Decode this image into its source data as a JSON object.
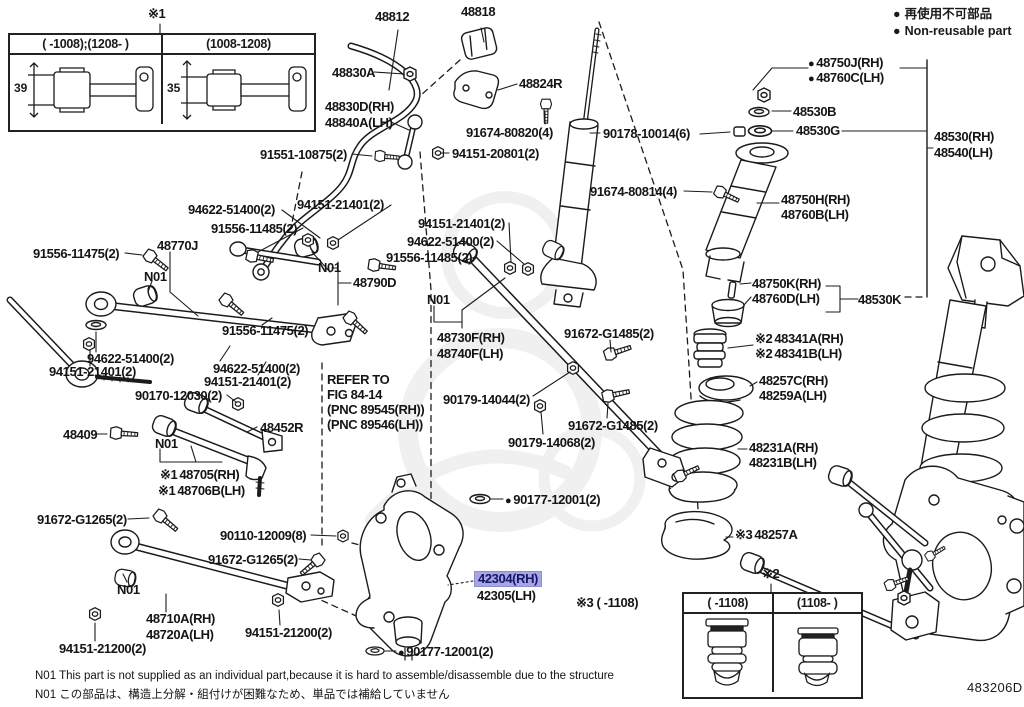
{
  "legend": {
    "bullet": "●",
    "jp": "再使用不可部品",
    "en": "Non-reusable part"
  },
  "markers": {
    "m1": "※1",
    "m2": "※2",
    "m3": "※3"
  },
  "table1": {
    "col1": "(      -1008);(1208-      )",
    "col2": "(1008-1208)",
    "dim1": "39",
    "dim2": "35"
  },
  "table2": {
    "col1": "(      -1108)",
    "col2": "(1108-      )"
  },
  "x3_note": "※3 (        -1108)",
  "notes": {
    "en": "N01   This part is not supplied as an individual part,because it is hard to assemble/disassemble due to the structure",
    "jp": "N01 この部品は、構造上分解・組付けが困難なため、単品では補給していません"
  },
  "doc_code": "483206D",
  "colors": {
    "highlight_bg": "#a7a5e2",
    "highlight_text": "#15156b",
    "line": "#1a1a1a"
  },
  "parts": {
    "p48812": "48812",
    "p48818": "48818",
    "p48830A": "48830A",
    "p48824R": "48824R",
    "p48830D": "48830D(RH)",
    "p48840A": "48840A(LH)",
    "p91674_80820": "91674-80820(4)",
    "p91551_10875": "91551-10875(2)",
    "p94151_20801": "94151-20801(2)",
    "p90178_10014": "90178-10014(6)",
    "p91674_80814": "91674-80814(4)",
    "p48750J": "48750J(RH)",
    "p48760C": "48760C(LH)",
    "p48530B": "48530B",
    "p48530G": "48530G",
    "p48530": "48530(RH)",
    "p48540": "48540(LH)",
    "p48750H": "48750H(RH)",
    "p48760B": "48760B(LH)",
    "p48750K": "48750K(RH)",
    "p48760D": "48760D(LH)",
    "p48530K": "48530K",
    "p48341A": "48341A(RH)",
    "p48341B": "48341B(LH)",
    "p48257C": "48257C(RH)",
    "p48259A": "48259A(LH)",
    "p48231A": "48231A(RH)",
    "p48231B": "48231B(LH)",
    "p48257A": "48257A",
    "p94622_51400": "94622-51400(2)",
    "p91556_11485": "91556-11485(2)",
    "p94151_21401": "94151-21401(2)",
    "p91556_11475": "91556-11475(2)",
    "p48770J": "48770J",
    "p48790D": "48790D",
    "p48730F": "48730F(RH)",
    "p48740F": "48740F(LH)",
    "p91672_G1485": "91672-G1485(2)",
    "p90179_14044": "90179-14044(2)",
    "p90179_14068": "90179-14068(2)",
    "p90170_12030": "90170-12030(2)",
    "p48409": "48409",
    "p48452R": "48452R",
    "p48705": "48705(RH)",
    "p48706B": "48706B(LH)",
    "p91672_G1265": "91672-G1265(2)",
    "p90110_12009": "90110-12009(8)",
    "p48710A": "48710A(RH)",
    "p48720A": "48720A(LH)",
    "p94151_21200": "94151-21200(2)",
    "p42304": "42304(RH)",
    "p42305": "42305(LH)",
    "p90177_12001": "90177-12001(2)",
    "pN01": "N01",
    "ref1": "REFER TO",
    "ref2": "FIG 84-14",
    "ref3": "(PNC 89545(RH))",
    "ref4": "(PNC 89546(LH))"
  }
}
